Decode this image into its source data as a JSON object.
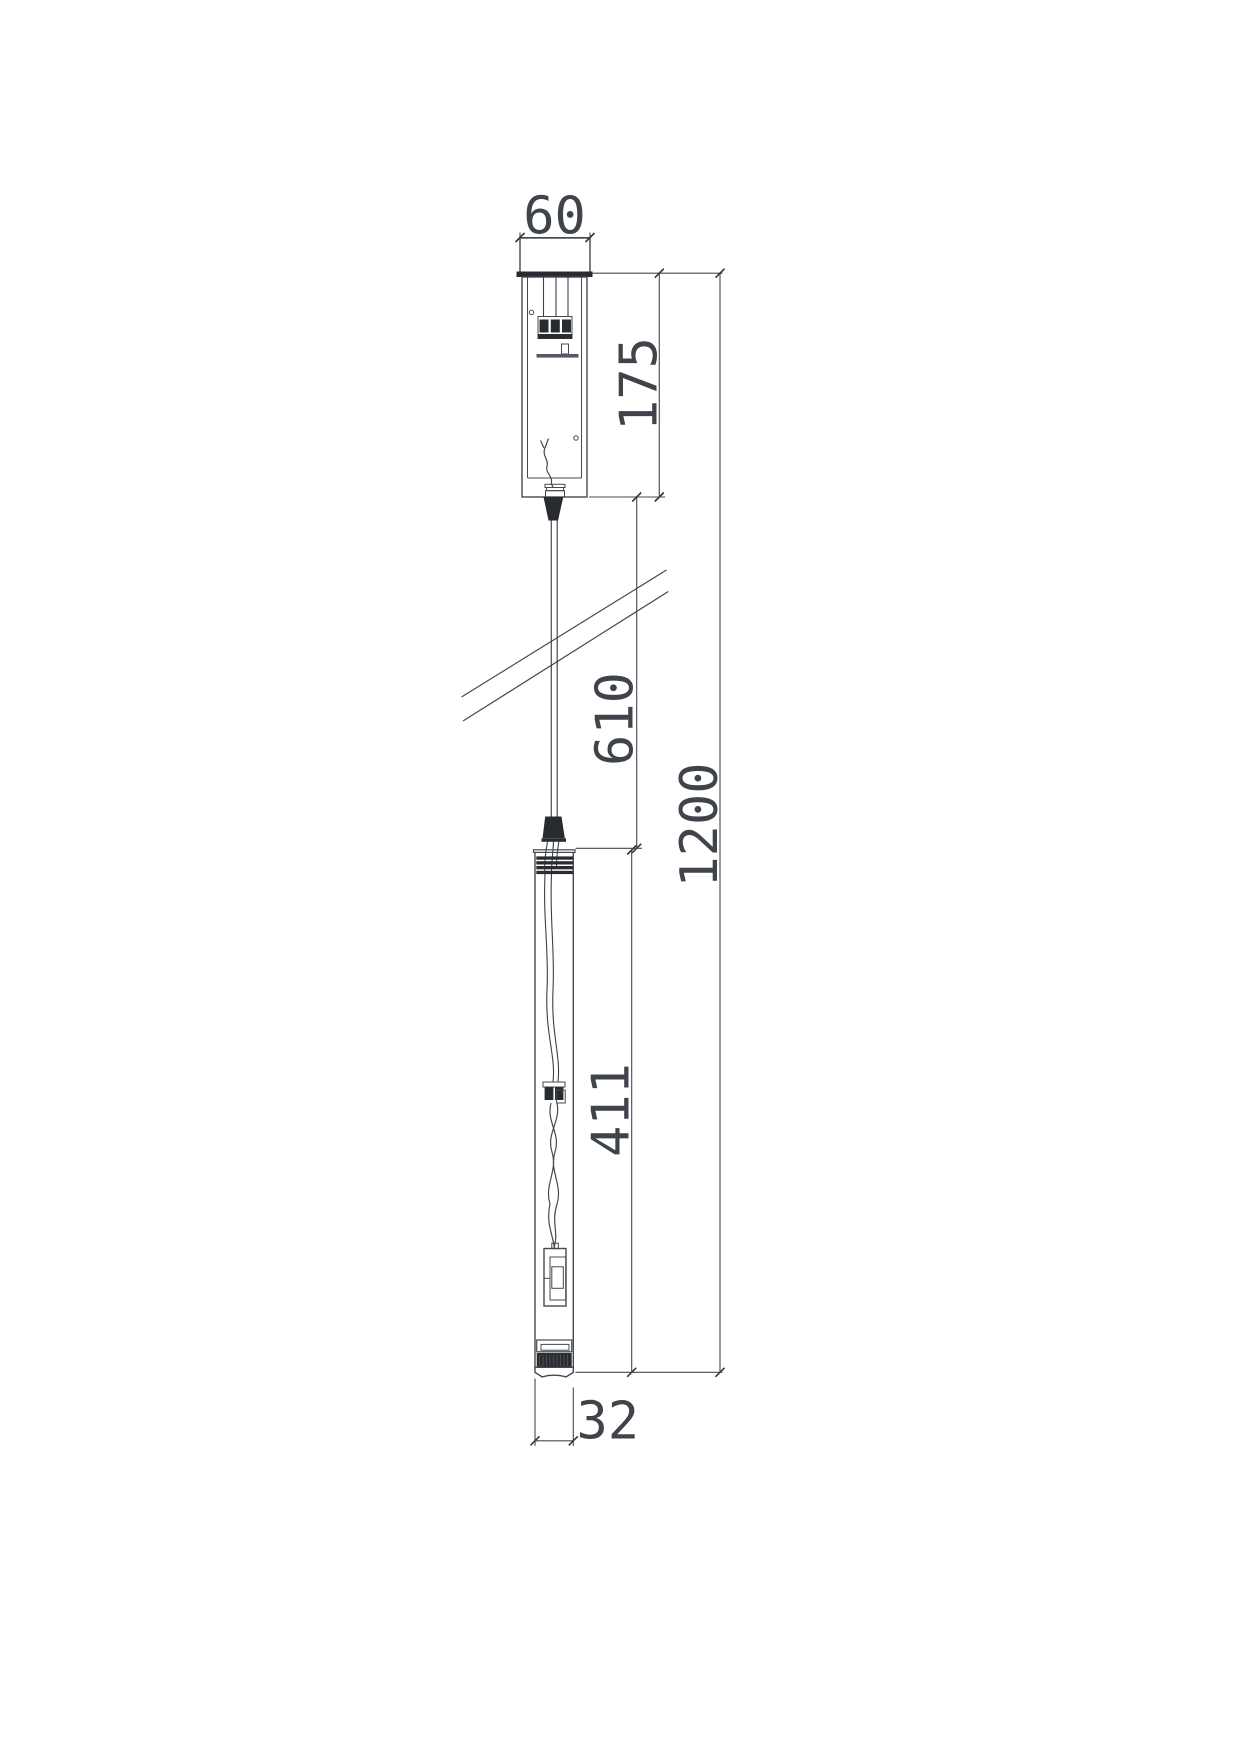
{
  "drawing": {
    "type": "technical-dimension-drawing",
    "subject": "pendant-light-fixture-side-view",
    "background_color": "#ffffff",
    "line_color": "#45494e",
    "dark_fill_color": "#282b30",
    "text_color": "#3f434a",
    "dimensions": {
      "canopy_width": "60",
      "canopy_height": "175",
      "suspension_cable_length": "610",
      "overall_drop_length": "1200",
      "tube_length": "411",
      "tube_diameter": "32"
    }
  }
}
